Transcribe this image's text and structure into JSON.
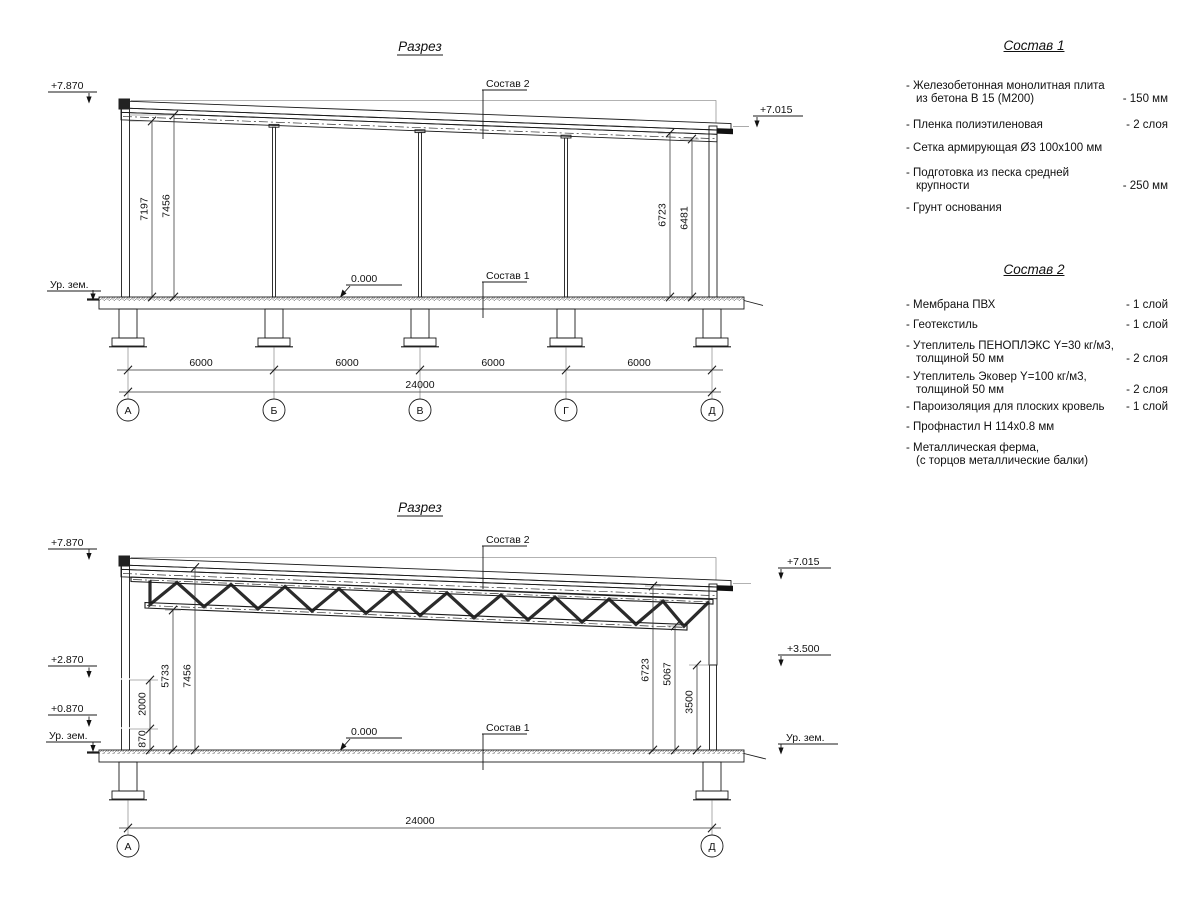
{
  "top": {
    "title": "Разрез",
    "elev_left": "+7.870",
    "elev_right": "+7.015",
    "ground_label": "Ур. зем.",
    "zero_label": "0.000",
    "sostav1_ref": "Состав 1",
    "sostav2_ref": "Состав 2",
    "dim_left_inner": "7197",
    "dim_left_outer": "7456",
    "dim_right_inner": "6723",
    "dim_right_outer": "6481",
    "spans": [
      "6000",
      "6000",
      "6000",
      "6000"
    ],
    "total": "24000",
    "axes": [
      "А",
      "Б",
      "В",
      "Г",
      "Д"
    ]
  },
  "bottom": {
    "title": "Разрез",
    "elev_left_top": "+7.870",
    "elev_left_mid": "+2.870",
    "elev_left_low": "+0.870",
    "elev_right_top": "+7.015",
    "elev_right_mid": "+3.500",
    "ground_left": "Ур. зем.",
    "ground_right": "Ур. зем.",
    "zero_label": "0.000",
    "sostav1_ref": "Состав 1",
    "sostav2_ref": "Состав 2",
    "dim_870": "870",
    "dim_2000": "2000",
    "dim_5733": "5733",
    "dim_7456": "7456",
    "dim_6723": "6723",
    "dim_5067": "5067",
    "dim_3500": "3500",
    "total": "24000",
    "axes": [
      "А",
      "Д"
    ]
  },
  "sostav1": {
    "title": "Состав 1",
    "items": [
      {
        "name": "- Железобетонная монолитная плита\nиз бетона В 15 (М200)",
        "value": "- 150 мм"
      },
      {
        "name": "- Пленка полиэтиленовая",
        "value": "- 2 слоя"
      },
      {
        "name": "- Сетка армирующая Ø3 100х100 мм",
        "value": ""
      },
      {
        "name": "- Подготовка из песка средней\nкрупности",
        "value": "- 250 мм"
      },
      {
        "name": "- Грунт основания",
        "value": ""
      }
    ]
  },
  "sostav2": {
    "title": "Состав 2",
    "items": [
      {
        "name": "- Мембрана ПВХ",
        "value": "- 1 слой"
      },
      {
        "name": "- Геотекстиль",
        "value": "- 1 слой"
      },
      {
        "name": "- Утеплитель ПЕНОПЛЭКС Y=30 кг/м3,\nтолщиной 50 мм",
        "value": "- 2 слоя"
      },
      {
        "name": "- Утеплитель Эковер Y=100 кг/м3,\nтолщиной 50 мм",
        "value": "- 2 слоя"
      },
      {
        "name": "- Пароизоляция для плоских кровель",
        "value": "- 1 слой"
      },
      {
        "name": "- Профнастил Н 114х0.8 мм",
        "value": ""
      },
      {
        "name": "- Металлическая ферма,\n(с торцов металлические балки)",
        "value": ""
      }
    ]
  }
}
